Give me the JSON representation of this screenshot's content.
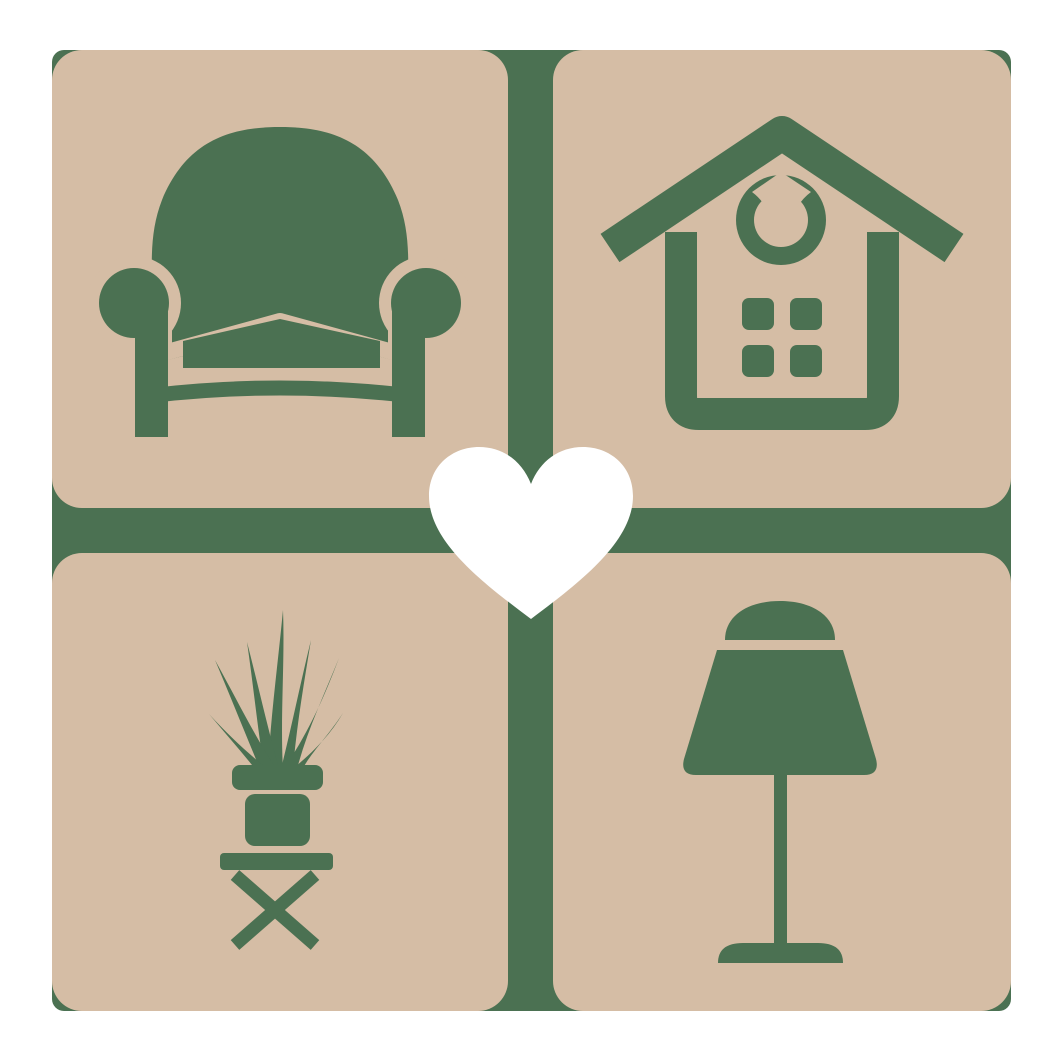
{
  "logo": {
    "alt": "Home furnishings logo: four rounded squares with armchair, house, potted plant and table lamp icons around a central heart",
    "colors": {
      "page_background": "#ffffff",
      "tile_beige": "#d5bda5",
      "icon_green": "#4b7152",
      "heart_white": "#ffffff"
    },
    "tiles": [
      {
        "position": "top-left",
        "icon": "armchair-icon",
        "label": "Armchair"
      },
      {
        "position": "top-right",
        "icon": "house-icon",
        "label": "House"
      },
      {
        "position": "bottom-left",
        "icon": "potted-plant-icon",
        "label": "Potted plant on stool"
      },
      {
        "position": "bottom-right",
        "icon": "table-lamp-icon",
        "label": "Table lamp"
      }
    ],
    "center_icon": {
      "name": "heart-icon",
      "label": "Heart"
    }
  }
}
